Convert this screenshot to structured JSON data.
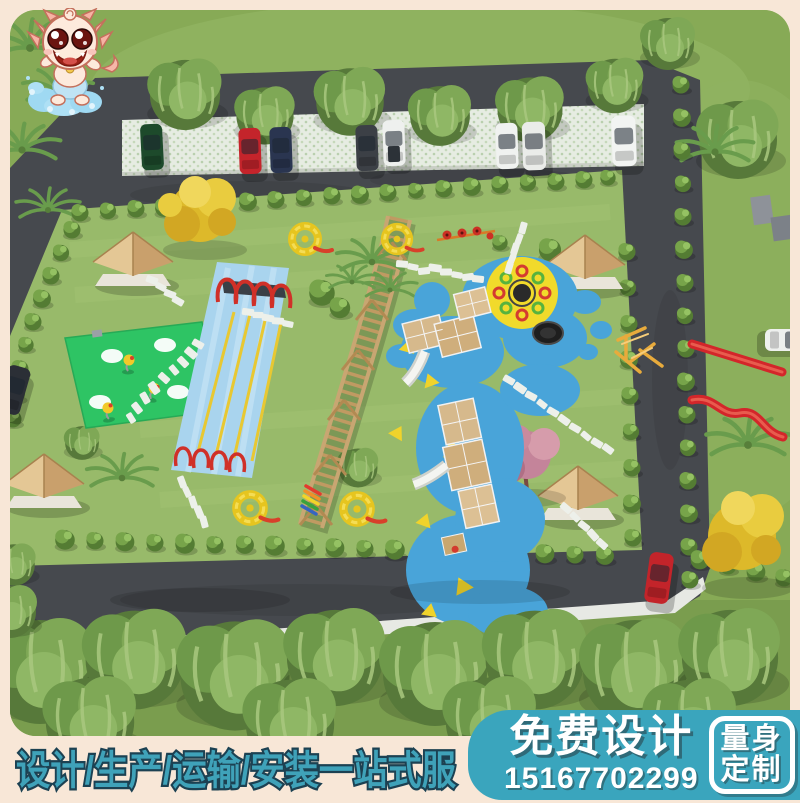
{
  "frame": {
    "background": "#f8e7d7"
  },
  "footer": {
    "service_text": "设计/生产/运输/安装一站式服",
    "text_color": "#3fa2b9",
    "outline_color": "#1c4152"
  },
  "promo": {
    "title": "免费设计",
    "phone": "15167702299",
    "badge": {
      "line1": "量身",
      "line2": "定制"
    },
    "panel_color": "#3aa5bd",
    "text_color": "#ffffff"
  },
  "scene": {
    "type": "aerial-3d-playground-park-render",
    "elements": [
      "dragon-mascot-logo",
      "willow-tree-row",
      "parking-lot",
      "parked-cars",
      "ring-road",
      "park-lawn",
      "gazebos",
      "swing-zipline-track",
      "rope-bridge",
      "wooden-play-structure",
      "blue-splash-pad",
      "yellow-spinner-circle",
      "trampoline",
      "red-slides",
      "green-play-mat",
      "stepping-stone-paths",
      "shrub-borders",
      "yellow-trees",
      "pink-tree",
      "palm-trees",
      "forest-row",
      "red-car-on-road"
    ],
    "colors": {
      "grass": "#87aa56",
      "lawn": "#98ba6a",
      "road": "#46494e",
      "splash_pad": "#49a4d9",
      "spinner_circle": "#f1da2b",
      "slide_red": "#d3262a",
      "wood": "#d2b58a",
      "mat_green": "#2ec464"
    }
  }
}
